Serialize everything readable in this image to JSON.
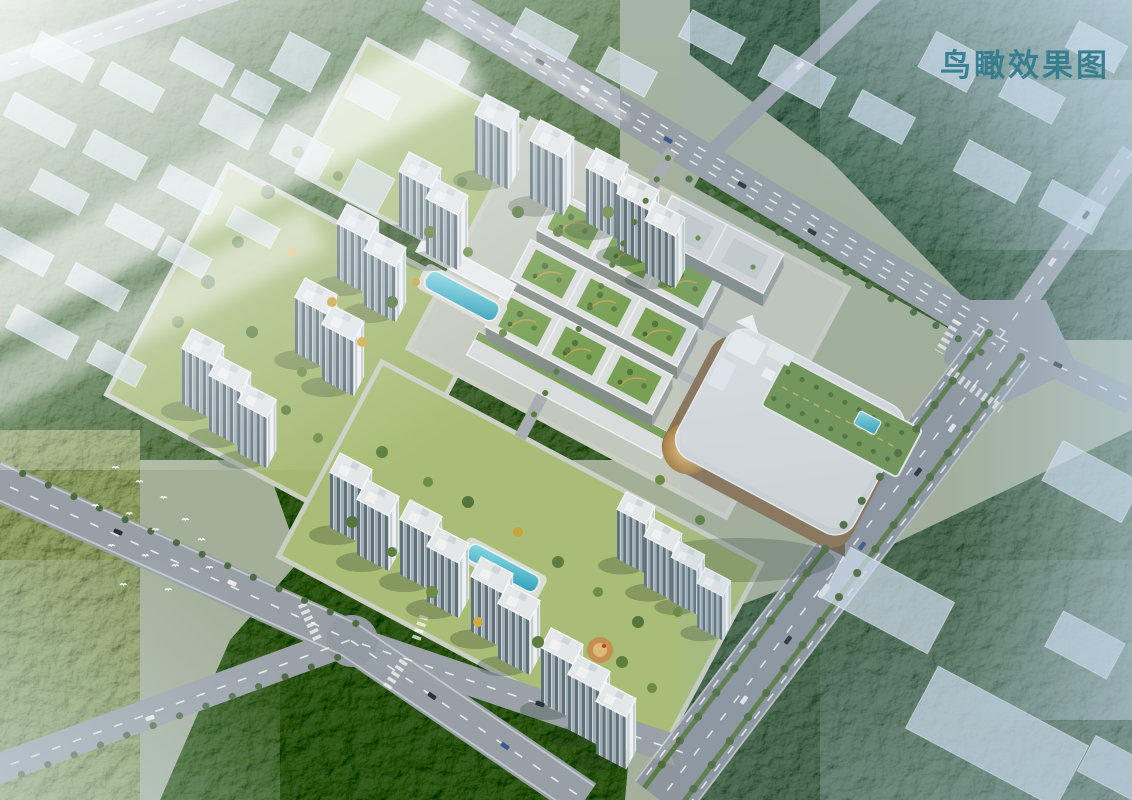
{
  "caption": {
    "text": "鸟瞰效果图",
    "color": "#2f7a8e"
  },
  "palette": {
    "haze": "#dfe9f1",
    "sky_tint": "#aac4d6",
    "foliage_dark": "#4f6b45",
    "foliage_blue_green": "#5d7868",
    "lawn": "#a9bd76",
    "road_asphalt": "#98a0a6",
    "avenue_asphalt": "#8e969d",
    "road_marking": "#f5f7f7",
    "tower_roof": "#e3e7e8",
    "tower_facade_lit": "#eef1f1",
    "tower_facade_shaded": "#9fadb3",
    "context_massing_block": "#ccd7e4",
    "commercial_roof": "#dadedd",
    "roof_garden": "#79a055",
    "mall_roof": "#d6dadb",
    "mall_facade_bronze": "#8a7254",
    "mall_facade_gold": "#c8a25e",
    "pool_water": "#45b6cd",
    "accent_tree_yellow": "#d1a945"
  },
  "scene": {
    "type": "aerial-architectural-rendering",
    "elements": [
      "residential high-rise towers",
      "green-roof commercial street blocks",
      "shopping mall with rooftop garden and pool",
      "courtyard swimming pools",
      "tree-lined avenue and road network",
      "semi-transparent context massing blocks",
      "forest and parkland",
      "flock of white birds"
    ]
  }
}
